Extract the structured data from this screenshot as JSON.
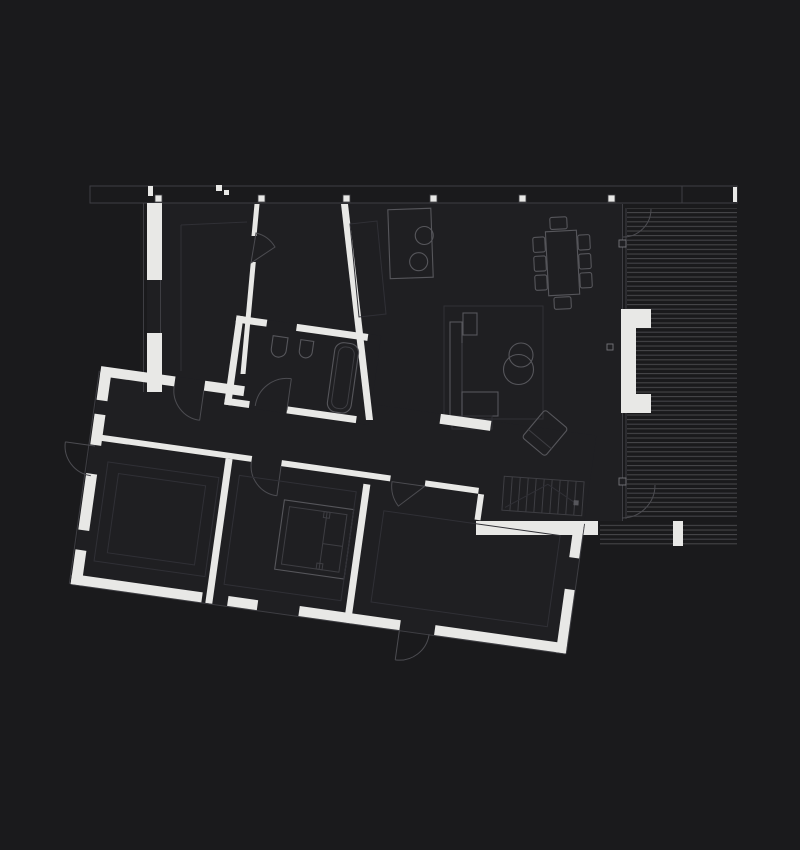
{
  "colors": {
    "background": "#1a1a1c",
    "interior": "#1f1f22",
    "wall": "#e8e8e6",
    "line": "#56565b",
    "line_dim": "#3e3e43",
    "line_faint": "#303036",
    "hatch": "#47474b",
    "arc": "#4c4c51"
  },
  "plan": {
    "type": "architectural-floor-plan",
    "style": "dark background, white cut walls, thin gray furniture linework, hatched wood deck",
    "wings": [
      {
        "name": "main-wing",
        "orientation": "orthogonal",
        "contents": [
          "bedroom",
          "bathroom-corridor",
          "open-plan-kitchen-living-dining"
        ]
      },
      {
        "name": "lower-wing",
        "orientation": "rotated-8-degrees",
        "contents": [
          "entry",
          "bathroom",
          "bedrooms",
          "shower-room",
          "hall"
        ]
      },
      {
        "name": "deck",
        "orientation": "orthogonal",
        "contents": [
          "plank-hatching",
          "outdoor-fireplace-bench",
          "step-block"
        ]
      }
    ],
    "elements": [
      "roof-eaves-band",
      "band-column-markers",
      "exterior-walls",
      "window-openings",
      "door-swing-arcs",
      "glass-facade-line",
      "facade-mullion-markers",
      "deck-plank-hatching",
      "outdoor-fireplace-bench",
      "deck-step-block",
      "kitchen-island",
      "island-sinks",
      "kitchen-counter-outline",
      "dining-table",
      "dining-chairs",
      "area-rug",
      "sectional-sofa",
      "sofa-side-table",
      "coffee-tables",
      "lounge-chair",
      "bedroom-partition",
      "bedroom-closet-outline",
      "bathroom-sink",
      "toilet",
      "bathtub",
      "shower-enclosure",
      "staircase",
      "closet-outlines"
    ],
    "counts": {
      "dining_chairs": 8,
      "coffee_tables": 2,
      "island_sinks": 2,
      "band_markers": 6,
      "door_arcs": 10
    }
  }
}
